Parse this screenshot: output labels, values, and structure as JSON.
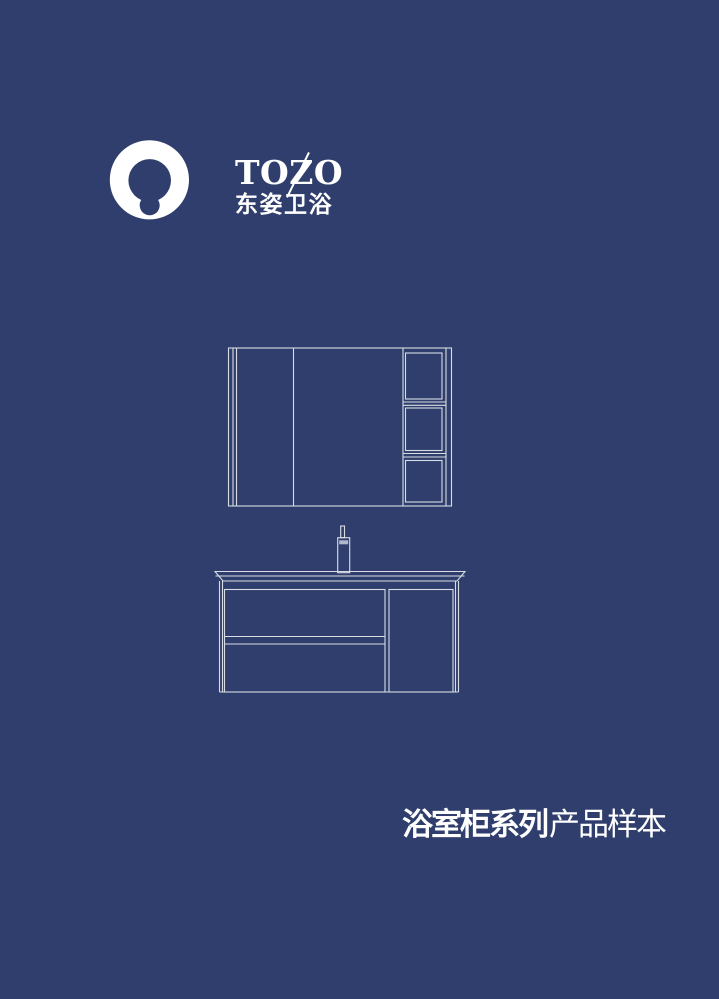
{
  "logo": {
    "brand": "TOZO",
    "brand_chinese": "东姿卫浴"
  },
  "cover_title": {
    "series": "浴室柜系列",
    "suffix": "产品样本"
  },
  "colors": {
    "background": "#2f3e6c",
    "line_art": "#d9dde3",
    "text": "#ffffff"
  },
  "illustration": {
    "description": "line drawing of bathroom mirror cabinet above a vanity cabinet with faucet, countertop, two drawers and a side door"
  }
}
